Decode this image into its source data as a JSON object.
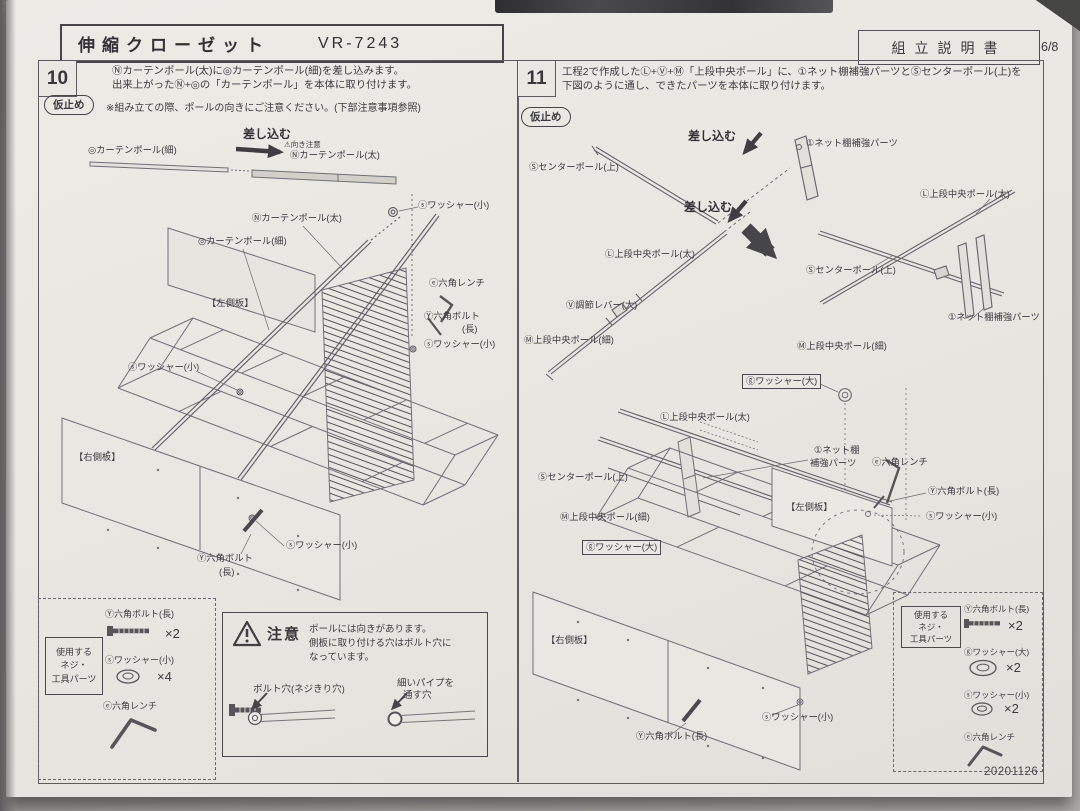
{
  "page": {
    "product_title": "伸縮クローゼット",
    "model": "VR-7243",
    "doc_title": "組立説明書",
    "page_number": "6/8",
    "date_code": "20201126"
  },
  "step10": {
    "number": "10",
    "instructions": [
      "Ⓝカーテンポール(太)に◎カーテンポール(細)を差し込みます。",
      "出来上がったⓃ+◎の「カーテンポール」を本体に取り付けます。"
    ],
    "tack_label": "仮止め",
    "note": "※組み立ての際、ポールの向きにご注意ください。(下部注意事項参照)",
    "labels": [
      {
        "t": "◎カーテンポール(細)",
        "x": 88,
        "y": 146
      },
      {
        "t": "差し込む",
        "x": 243,
        "y": 128,
        "fs": 12,
        "b": true
      },
      {
        "t": "⚠向き注意",
        "x": 284,
        "y": 141,
        "fs": 7.5
      },
      {
        "t": "Ⓝカーテンポール(太)",
        "x": 290,
        "y": 151
      },
      {
        "t": "ⓢワッシャー(小)",
        "x": 418,
        "y": 201
      },
      {
        "t": "Ⓝカーテンポール(太)",
        "x": 252,
        "y": 214
      },
      {
        "t": "◎カーテンポール(細)",
        "x": 198,
        "y": 237
      },
      {
        "t": "ⓔ六角レンチ",
        "x": 429,
        "y": 279
      },
      {
        "t": "【左側板】",
        "x": 207,
        "y": 299
      },
      {
        "t": "Ⓨ六角ボルト",
        "x": 424,
        "y": 312
      },
      {
        "t": "(長)",
        "x": 462,
        "y": 325
      },
      {
        "t": "ⓢワッシャー(小)",
        "x": 424,
        "y": 340
      },
      {
        "t": "ⓢワッシャー(小)",
        "x": 128,
        "y": 363
      },
      {
        "t": "【右側板】",
        "x": 74,
        "y": 453
      },
      {
        "t": "ⓢワッシャー(小)",
        "x": 286,
        "y": 541
      },
      {
        "t": "Ⓨ六角ボルト",
        "x": 197,
        "y": 554
      },
      {
        "t": "(長)",
        "x": 219,
        "y": 568
      }
    ]
  },
  "step11": {
    "number": "11",
    "instructions": [
      "工程2で作成したⓁ+Ⓥ+Ⓜ「上段中央ポール」に、①ネット棚補強パーツとⓈセンターポール(上)を",
      "下図のように通し、できたパーツを本体に取り付けます。"
    ],
    "tack_label": "仮止め",
    "labels": [
      {
        "t": "差し込む",
        "x": 688,
        "y": 130,
        "fs": 12,
        "b": true
      },
      {
        "t": "①ネット棚補強パーツ",
        "x": 806,
        "y": 139
      },
      {
        "t": "Ⓢセンターポール(上)",
        "x": 529,
        "y": 163
      },
      {
        "t": "差し込む",
        "x": 684,
        "y": 201,
        "fs": 12,
        "b": true
      },
      {
        "t": "Ⓛ上段中央ポール(太)",
        "x": 920,
        "y": 190
      },
      {
        "t": "Ⓛ上段中央ポール(太)",
        "x": 605,
        "y": 250
      },
      {
        "t": "Ⓢセンターポール(上)",
        "x": 806,
        "y": 266
      },
      {
        "t": "Ⓥ調節レバー(大)",
        "x": 566,
        "y": 301
      },
      {
        "t": "①ネット棚補強パーツ",
        "x": 948,
        "y": 313
      },
      {
        "t": "Ⓜ上段中央ポール(細)",
        "x": 524,
        "y": 336
      },
      {
        "t": "Ⓜ上段中央ポール(細)",
        "x": 797,
        "y": 342
      },
      {
        "t": "ⓖワッシャー(大)",
        "x": 742,
        "y": 374,
        "boxed": true
      },
      {
        "t": "Ⓛ上段中央ポール(太)",
        "x": 660,
        "y": 413
      },
      {
        "t": "①ネット棚",
        "x": 814,
        "y": 446
      },
      {
        "t": "補強パーツ",
        "x": 810,
        "y": 459
      },
      {
        "t": "ⓔ六角レンチ",
        "x": 872,
        "y": 458
      },
      {
        "t": "Ⓢセンターポール(上)",
        "x": 538,
        "y": 473
      },
      {
        "t": "Ⓨ六角ボルト(長)",
        "x": 928,
        "y": 487
      },
      {
        "t": "【左側板】",
        "x": 786,
        "y": 503
      },
      {
        "t": "ⓢワッシャー(小)",
        "x": 926,
        "y": 512
      },
      {
        "t": "Ⓜ上段中央ポール(細)",
        "x": 560,
        "y": 513
      },
      {
        "t": "ⓖワッシャー(大)",
        "x": 582,
        "y": 540,
        "boxed": true
      },
      {
        "t": "【右側板】",
        "x": 546,
        "y": 636
      },
      {
        "t": "ⓢワッシャー(小)",
        "x": 762,
        "y": 713
      },
      {
        "t": "Ⓨ六角ボルト(長)",
        "x": 636,
        "y": 732
      }
    ]
  },
  "caution": {
    "title": "注意",
    "lines": [
      "ポールには向きがあります。",
      "側板に取り付ける穴はボルト穴に",
      "なっています。"
    ],
    "bolt_hole_label": "ボルト穴(ネジきり穴)",
    "pipe_hole_label_1": "細いパイプを",
    "pipe_hole_label_2": "通す穴"
  },
  "parts_box10": {
    "title_lines": [
      "使用する",
      "ネジ・",
      "工具パーツ"
    ],
    "items": [
      {
        "name": "Ⓨ六角ボルト(長)",
        "qty": "×2",
        "icon": "bolt"
      },
      {
        "name": "ⓢワッシャー(小)",
        "qty": "×4",
        "icon": "washer-small"
      },
      {
        "name": "ⓔ六角レンチ",
        "qty": "",
        "icon": "allen-key"
      }
    ]
  },
  "parts_box11": {
    "title_lines": [
      "使用する",
      "ネジ・",
      "工具パーツ"
    ],
    "items": [
      {
        "name": "Ⓨ六角ボルト(長)",
        "qty": "×2",
        "icon": "bolt"
      },
      {
        "name": "ⓖワッシャー(大)",
        "qty": "×2",
        "icon": "washer-large"
      },
      {
        "name": "ⓢワッシャー(小)",
        "qty": "×2",
        "icon": "washer-small"
      },
      {
        "name": "ⓔ六角レンチ",
        "qty": "",
        "icon": "allen-key"
      }
    ]
  }
}
